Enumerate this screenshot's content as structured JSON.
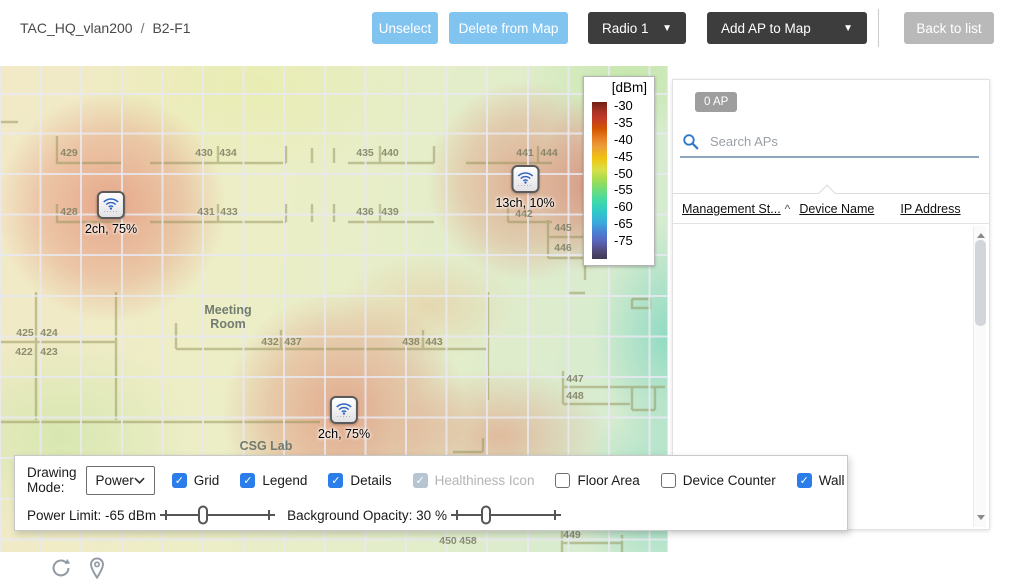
{
  "header": {
    "breadcrumb": {
      "site": "TAC_HQ_vlan200",
      "separator": "/",
      "floor": "B2-F1"
    },
    "unselect_button": "Unselect",
    "delete_button": "Delete from Map",
    "radio_dropdown": {
      "label": "Radio 1",
      "caret": "▼"
    },
    "add_ap_dropdown": {
      "label": "Add AP to Map",
      "caret": "▼"
    },
    "back_button": "Back to list"
  },
  "legend": {
    "title": "[dBm]",
    "ticks": [
      "-30",
      "-35",
      "-40",
      "-45",
      "-50",
      "-55",
      "-60",
      "-65",
      "-75"
    ]
  },
  "map": {
    "aps": [
      {
        "label": "2ch, 75%",
        "x": 111,
        "y": 141
      },
      {
        "label": "13ch, 10%",
        "x": 525,
        "y": 115
      },
      {
        "label": "2ch, 75%",
        "x": 344,
        "y": 346
      }
    ],
    "rooms": [
      {
        "number": "429",
        "x": 69,
        "y": 87
      },
      {
        "number": "430",
        "x": 204,
        "y": 87
      },
      {
        "number": "434",
        "x": 228,
        "y": 87
      },
      {
        "number": "435",
        "x": 365,
        "y": 87
      },
      {
        "number": "440",
        "x": 390,
        "y": 87
      },
      {
        "number": "441",
        "x": 525,
        "y": 87
      },
      {
        "number": "444",
        "x": 549,
        "y": 87
      },
      {
        "number": "428",
        "x": 69,
        "y": 146
      },
      {
        "number": "431",
        "x": 206,
        "y": 146
      },
      {
        "number": "433",
        "x": 229,
        "y": 146
      },
      {
        "number": "436",
        "x": 365,
        "y": 146
      },
      {
        "number": "439",
        "x": 390,
        "y": 146
      },
      {
        "number": "442",
        "x": 524,
        "y": 148
      },
      {
        "number": "445",
        "x": 563,
        "y": 162
      },
      {
        "number": "446",
        "x": 563,
        "y": 182
      },
      {
        "number": "425",
        "x": 25,
        "y": 267
      },
      {
        "number": "424",
        "x": 49,
        "y": 267
      },
      {
        "number": "422",
        "x": 24,
        "y": 286
      },
      {
        "number": "423",
        "x": 49,
        "y": 286
      },
      {
        "number": "432",
        "x": 270,
        "y": 276
      },
      {
        "number": "437",
        "x": 293,
        "y": 276
      },
      {
        "number": "438",
        "x": 411,
        "y": 276
      },
      {
        "number": "443",
        "x": 434,
        "y": 276
      },
      {
        "number": "447",
        "x": 575,
        "y": 313
      },
      {
        "number": "448",
        "x": 575,
        "y": 330
      },
      {
        "number": "449",
        "x": 572,
        "y": 469
      },
      {
        "number": "450",
        "x": 448,
        "y": 475
      },
      {
        "number": "458",
        "x": 468,
        "y": 475
      }
    ],
    "areas": [
      {
        "text": "Meeting\nRoom",
        "x": 228,
        "y": 251
      },
      {
        "text": "CSG Lab",
        "x": 266,
        "y": 380
      }
    ]
  },
  "sidebar": {
    "ap_count_badge": "0 AP",
    "search_placeholder": "Search APs",
    "columns": [
      "Management St...",
      "Device Name",
      "IP Address"
    ],
    "sort_indicator": "^"
  },
  "controls": {
    "drawing_mode": {
      "label": "Drawing Mode:",
      "value": "Power"
    },
    "checkboxes": [
      {
        "label": "Grid",
        "checked": true,
        "disabled": false
      },
      {
        "label": "Legend",
        "checked": true,
        "disabled": false
      },
      {
        "label": "Details",
        "checked": true,
        "disabled": false
      },
      {
        "label": "Healthiness Icon",
        "checked": true,
        "disabled": true
      },
      {
        "label": "Floor Area",
        "checked": false,
        "disabled": false
      },
      {
        "label": "Device Counter",
        "checked": false,
        "disabled": false
      },
      {
        "label": "Wall",
        "checked": true,
        "disabled": false
      }
    ],
    "power_limit": {
      "label": "Power Limit:",
      "value": "-65 dBm",
      "slider_percent": 36
    },
    "background_opacity": {
      "label": "Background Opacity:",
      "value": "30 %",
      "slider_percent": 30
    }
  },
  "colors": {
    "primary_button": "#82c4f0",
    "dark_button": "#3d3d3d",
    "inactive_button": "#b9b9b9",
    "checkbox_accent": "#2b7de9",
    "checkbox_disabled": "#b6c5d1",
    "search_underline": "#8da5bd",
    "badge_gray": "#9e9e9e",
    "heat_hot": "#de6854",
    "heat_cold": "#64d0ba"
  }
}
